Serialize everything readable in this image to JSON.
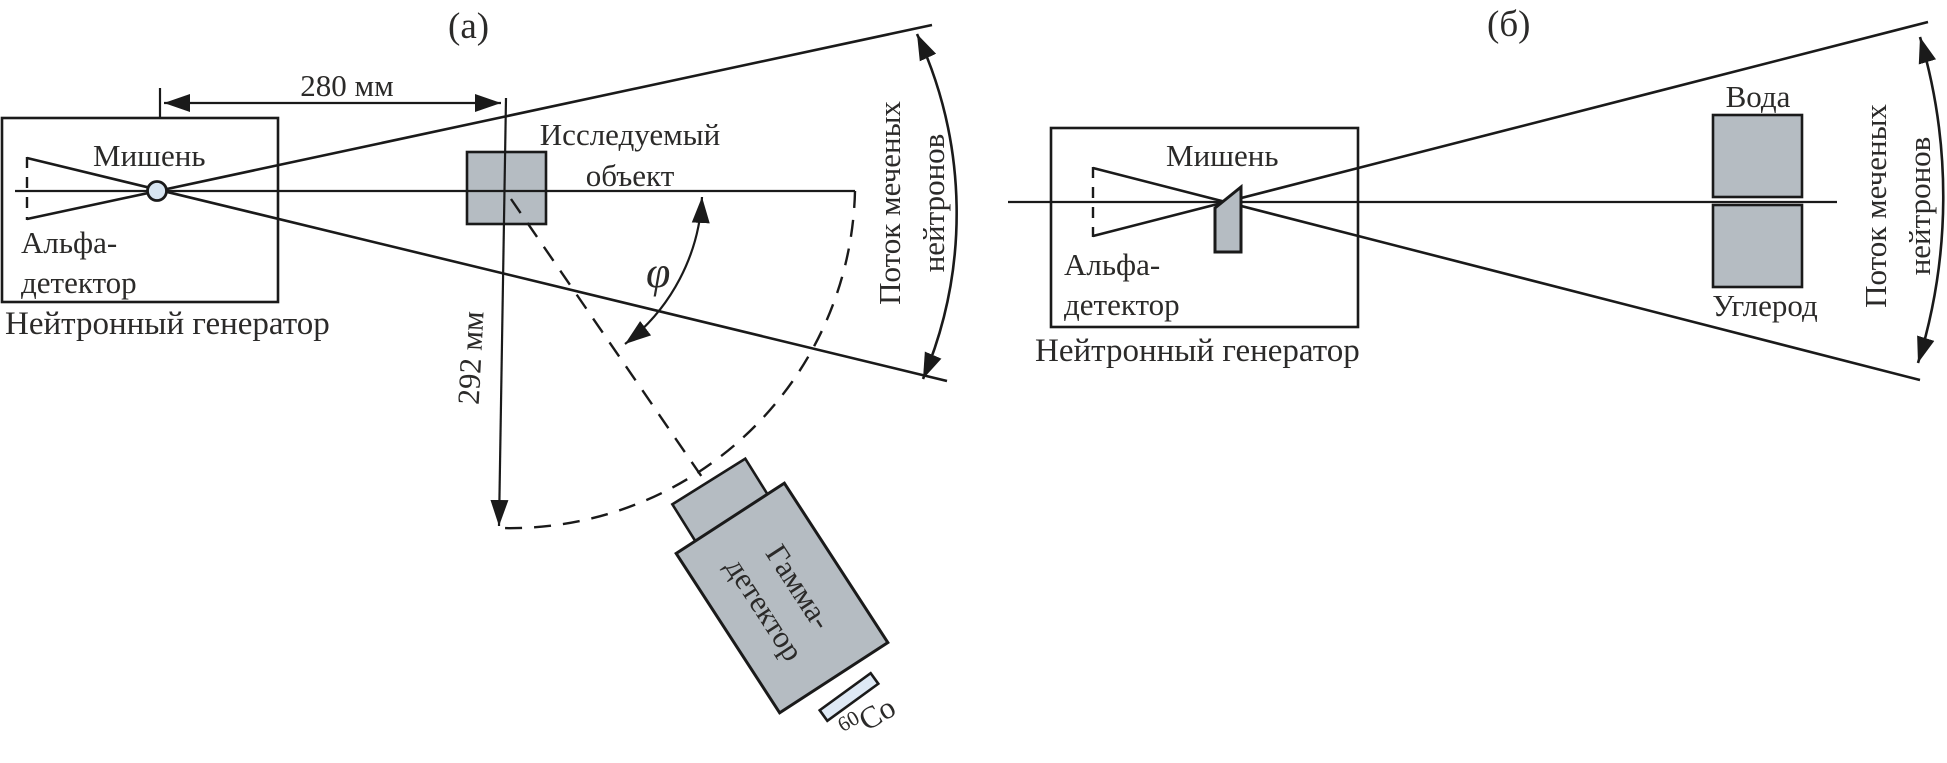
{
  "figure": {
    "panel_a": {
      "label": "(а)",
      "dim_horizontal": "280 мм",
      "dim_radial": "292 мм",
      "target": "Мишень",
      "alpha": {
        "line1": "Альфа-",
        "line2": "детектор"
      },
      "generator": "Нейтронный генератор",
      "object": {
        "line1": "Исследуемый",
        "line2": "объект"
      },
      "angle": "φ",
      "flux": {
        "line1": "Поток меченых",
        "line2": "нейтронов"
      },
      "gamma": {
        "line1": "Гамма-",
        "line2": "детектор"
      },
      "source": {
        "isotope": "60",
        "element": "Co"
      }
    },
    "panel_b": {
      "label": "(б)",
      "target": "Мишень",
      "alpha": {
        "line1": "Альфа-",
        "line2": "детектор"
      },
      "generator": "Нейтронный генератор",
      "water": "Вода",
      "carbon": "Углерод",
      "flux": {
        "line1": "Поток меченых",
        "line2": "нейтронов"
      }
    },
    "colors": {
      "line": "#1a1a1a",
      "text": "#2b2a29",
      "shape_gray": "#b5bcc2",
      "source_pale_blue": "#dee9f5",
      "target_circle_blue": "#d8e5f1",
      "background": "#ffffff"
    }
  }
}
